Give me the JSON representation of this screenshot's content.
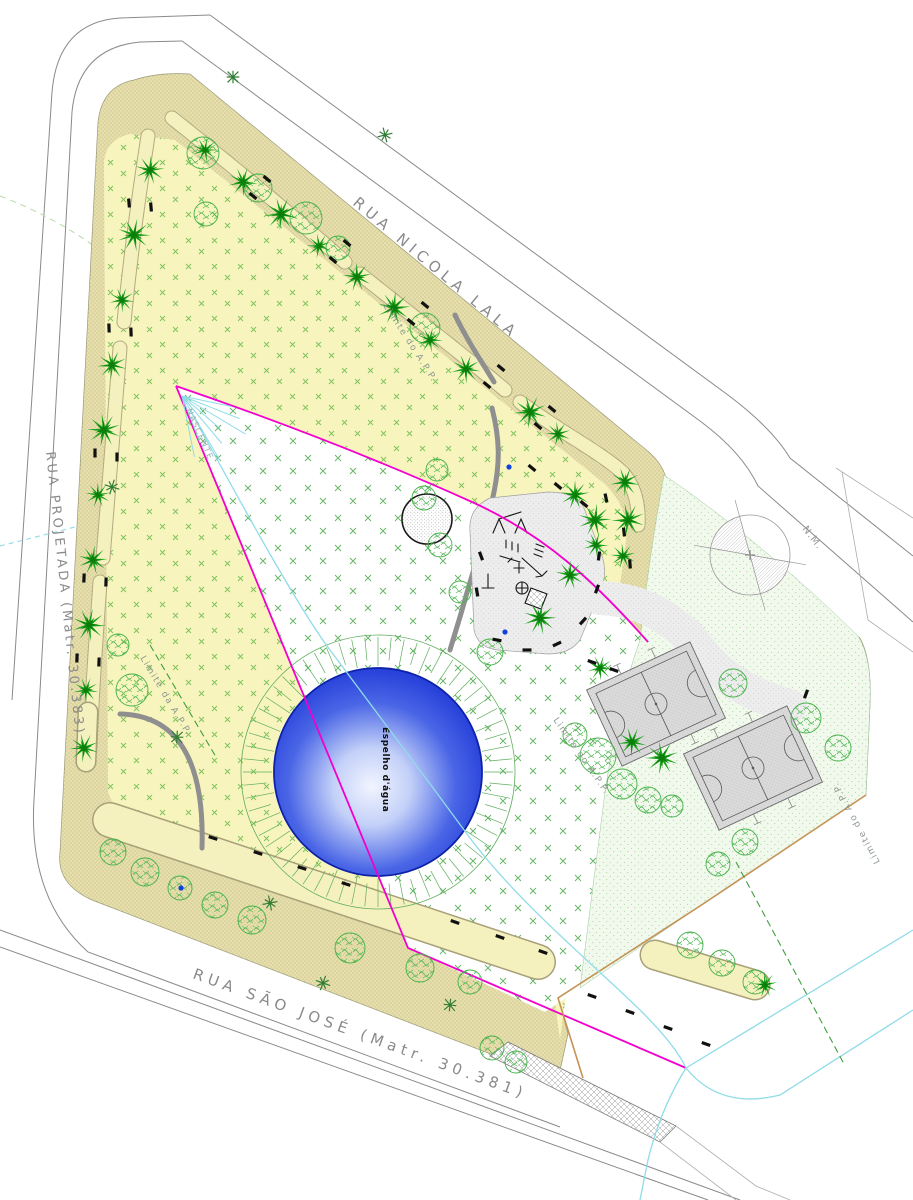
{
  "labels": {
    "street_top": "RUA NICOLA LALA",
    "street_left": "RUA PROJETADA (Matr. 30.383)",
    "street_bottom": "RUA SÃO JOSÉ (Matr. 30.381)",
    "water_mirror": "Espelho d'água",
    "spring": "NASCENTE",
    "magnetic_north": "N.M.",
    "app_limit_top": "Limite do A.P.P.",
    "app_limit_left": "Limite da A.P.P.",
    "app_limit_center": "Limite do A.P.P.",
    "app_limit_right": "Limite do A.P.P."
  },
  "colors": {
    "app_boundary_magenta": "#f200cc",
    "stream_cyan": "#8fdce8",
    "sidewalk_beige": "#e6dfab",
    "lawn_yellow": "#f7f4bd",
    "lawn_sparkle_green": "#7cc35a",
    "light_lawn_green": "#f1f8ec",
    "water_edge_blue": "#1b34d6",
    "water_center_light": "#f2f5ff",
    "ring_green": "#5fae5f",
    "palm_green": "#17a017",
    "palm_dark_green": "#0b7d0b",
    "tree_green": "#46b24a",
    "app_dashed_green": "#3f9e3f",
    "plaza_gray": "#ededed",
    "court_gray": "#dadada",
    "court_line_gray": "#5a5a5a",
    "street_line_gray": "#8a8a8a",
    "label_gray": "#8a8a8a",
    "sand_tan": "#c49355",
    "bench_black": "#111111",
    "fountain_dot_blue": "#1040e0"
  },
  "scene": {
    "water": {
      "cx": 378,
      "cy": 772,
      "r": 104,
      "ring_r": 137,
      "ticks": 64
    },
    "spring": {
      "x": 182,
      "y": 396,
      "rays": 8
    },
    "palms": [
      [
        205,
        150
      ],
      [
        243,
        182
      ],
      [
        281,
        214
      ],
      [
        319,
        246
      ],
      [
        357,
        277
      ],
      [
        394,
        308
      ],
      [
        430,
        340
      ],
      [
        466,
        369
      ],
      [
        530,
        412
      ],
      [
        558,
        434
      ],
      [
        575,
        495
      ],
      [
        595,
        520
      ],
      [
        596,
        545
      ],
      [
        625,
        482
      ],
      [
        628,
        520
      ],
      [
        623,
        556
      ],
      [
        570,
        575
      ],
      [
        540,
        618
      ],
      [
        600,
        668
      ],
      [
        632,
        742
      ],
      [
        662,
        758
      ],
      [
        765,
        985
      ],
      [
        150,
        170
      ],
      [
        134,
        235
      ],
      [
        122,
        300
      ],
      [
        112,
        365
      ],
      [
        104,
        430
      ],
      [
        98,
        495
      ],
      [
        93,
        560
      ],
      [
        89,
        625
      ],
      [
        86,
        690
      ],
      [
        84,
        748
      ]
    ],
    "round_trees": [
      [
        203,
        153,
        16
      ],
      [
        258,
        188,
        14
      ],
      [
        206,
        214,
        12
      ],
      [
        306,
        218,
        16
      ],
      [
        338,
        248,
        12
      ],
      [
        425,
        328,
        15
      ],
      [
        118,
        645,
        11
      ],
      [
        132,
        690,
        16
      ],
      [
        437,
        470,
        11
      ],
      [
        424,
        498,
        12
      ],
      [
        440,
        545,
        12
      ],
      [
        460,
        592,
        11
      ],
      [
        490,
        652,
        13
      ],
      [
        575,
        735,
        12
      ],
      [
        598,
        756,
        18
      ],
      [
        622,
        784,
        15
      ],
      [
        648,
        800,
        13
      ],
      [
        672,
        806,
        11
      ],
      [
        733,
        683,
        14
      ],
      [
        806,
        718,
        15
      ],
      [
        838,
        748,
        13
      ],
      [
        745,
        842,
        13
      ],
      [
        718,
        864,
        12
      ],
      [
        113,
        852,
        13
      ],
      [
        145,
        872,
        14
      ],
      [
        180,
        888,
        12
      ],
      [
        215,
        905,
        13
      ],
      [
        252,
        920,
        14
      ],
      [
        350,
        948,
        15
      ],
      [
        420,
        968,
        14
      ],
      [
        470,
        982,
        12
      ],
      [
        690,
        945,
        13
      ],
      [
        722,
        963,
        13
      ],
      [
        755,
        982,
        12
      ],
      [
        492,
        1048,
        12
      ],
      [
        516,
        1062,
        11
      ]
    ],
    "x_trees": [
      [
        233,
        77
      ],
      [
        385,
        135
      ],
      [
        112,
        487
      ],
      [
        177,
        737
      ],
      [
        270,
        903
      ],
      [
        323,
        983
      ],
      [
        450,
        1005
      ]
    ],
    "benches": [
      [
        253,
        196,
        40
      ],
      [
        267,
        179,
        40
      ],
      [
        333,
        260,
        40
      ],
      [
        347,
        243,
        40
      ],
      [
        411,
        322,
        40
      ],
      [
        425,
        305,
        40
      ],
      [
        487,
        385,
        40
      ],
      [
        501,
        368,
        40
      ],
      [
        538,
        426,
        40
      ],
      [
        552,
        409,
        40
      ],
      [
        606,
        498,
        78
      ],
      [
        624,
        532,
        84
      ],
      [
        630,
        564,
        86
      ],
      [
        129,
        203,
        85
      ],
      [
        151,
        207,
        85
      ],
      [
        109,
        328,
        88
      ],
      [
        131,
        332,
        88
      ],
      [
        95,
        453,
        90
      ],
      [
        117,
        457,
        90
      ],
      [
        84,
        578,
        92
      ],
      [
        106,
        582,
        92
      ],
      [
        77,
        658,
        92
      ],
      [
        99,
        662,
        92
      ],
      [
        213,
        838,
        18
      ],
      [
        258,
        853,
        18
      ],
      [
        302,
        868,
        18
      ],
      [
        346,
        884,
        18
      ],
      [
        455,
        922,
        20
      ],
      [
        500,
        937,
        20
      ],
      [
        543,
        952,
        20
      ],
      [
        592,
        996,
        20
      ],
      [
        630,
        1012,
        20
      ],
      [
        668,
        1028,
        20
      ],
      [
        706,
        1044,
        20
      ],
      [
        481,
        556,
        70
      ],
      [
        477,
        592,
        80
      ],
      [
        497,
        640,
        10
      ],
      [
        527,
        650,
        0
      ],
      [
        557,
        644,
        -25
      ],
      [
        583,
        621,
        -48
      ],
      [
        597,
        589,
        -70
      ],
      [
        599,
        556,
        -82
      ],
      [
        532,
        468,
        40
      ],
      [
        558,
        486,
        40
      ],
      [
        584,
        504,
        40
      ],
      [
        592,
        662,
        20
      ],
      [
        614,
        670,
        20
      ],
      [
        806,
        694,
        110
      ]
    ],
    "blue_dots": [
      [
        509,
        467
      ],
      [
        505,
        632
      ],
      [
        181,
        888
      ]
    ]
  }
}
